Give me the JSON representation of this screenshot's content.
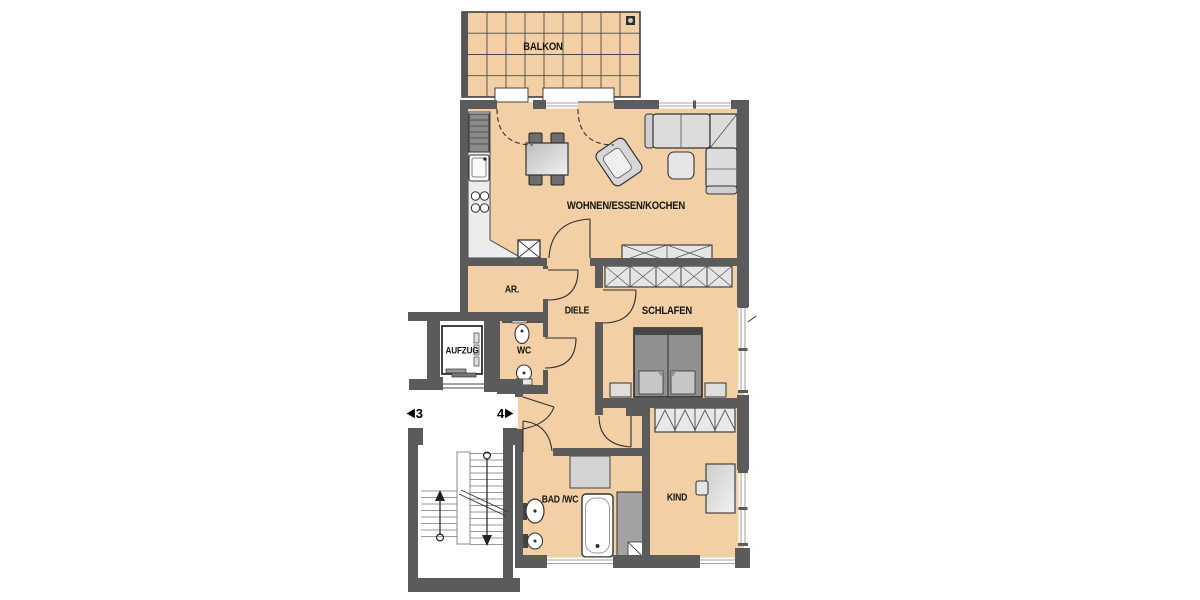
{
  "title": "Wohnung 4 Grundriss (floor plan)",
  "colors": {
    "floor_tan": "#f2cfa5",
    "wall_gray": "#5b5b5b",
    "line_dark": "#2e2e2e",
    "furniture_light": "#dcdcdc",
    "furniture_dark": "#6e6e6e",
    "mattress_gray": "#909090",
    "window_white": "#ffffff"
  },
  "rooms": {
    "balkon": {
      "label": "BALKON"
    },
    "wohnen": {
      "label": "WOHNEN/ESSEN/KOCHEN"
    },
    "ar": {
      "label": "AR."
    },
    "diele": {
      "label": "DIELE"
    },
    "wc": {
      "label": "WC"
    },
    "schlafen": {
      "label": "SCHLAFEN"
    },
    "aufzug": {
      "label": "AUFZUG"
    },
    "bad": {
      "label": "BAD /WC"
    },
    "kind": {
      "label": "KIND"
    }
  },
  "markers": {
    "unit_left": "3",
    "unit_right": "4"
  },
  "icons": {
    "arrow_left": "◀",
    "arrow_right": "▶"
  }
}
